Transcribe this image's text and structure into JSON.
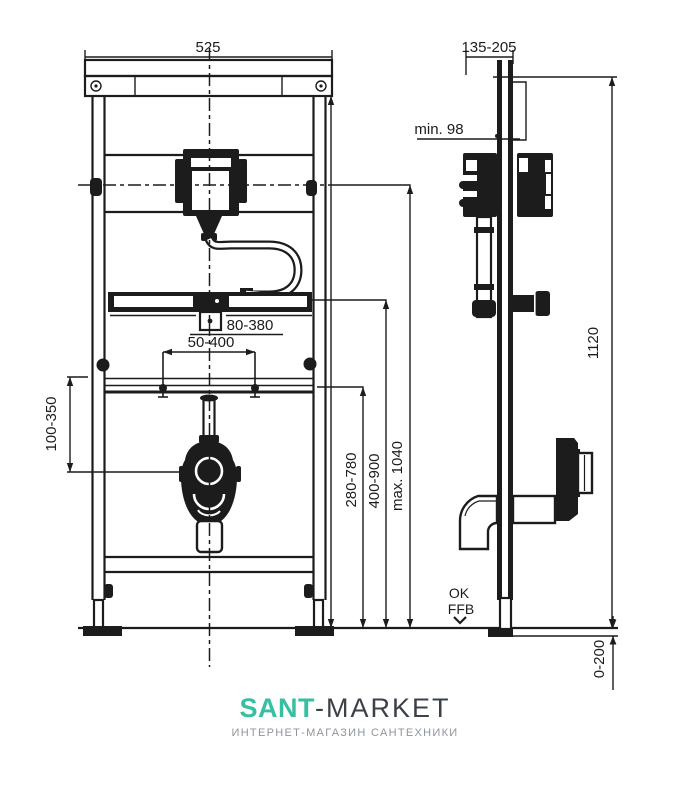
{
  "drawing": {
    "title_hint": "installation frame for urinal, front and side technical views",
    "dims": {
      "front_width": "525",
      "depth_range": "135-205",
      "min_depth": "min. 98",
      "plate_range": "80-380",
      "stud_range": "50-400",
      "siphon_range": "100-350",
      "height_rail": "280-780",
      "height_plate": "400-900",
      "height_max": "max. 1040",
      "total_height": "1120",
      "floor_adjust": "0-200"
    },
    "labels": {
      "floor_ref_top": "OK",
      "floor_ref_bottom": "FFB"
    },
    "line_color": "#1c1c1c"
  },
  "logo": {
    "brand_primary": "SANT",
    "brand_secondary": "-MARKET",
    "tagline": "ИНТЕРНЕТ-МАГАЗИН САНТЕХНИКИ",
    "colors": {
      "primary": "#38BFA1",
      "secondary": "#3B4149",
      "tagline": "#8F959D"
    }
  }
}
